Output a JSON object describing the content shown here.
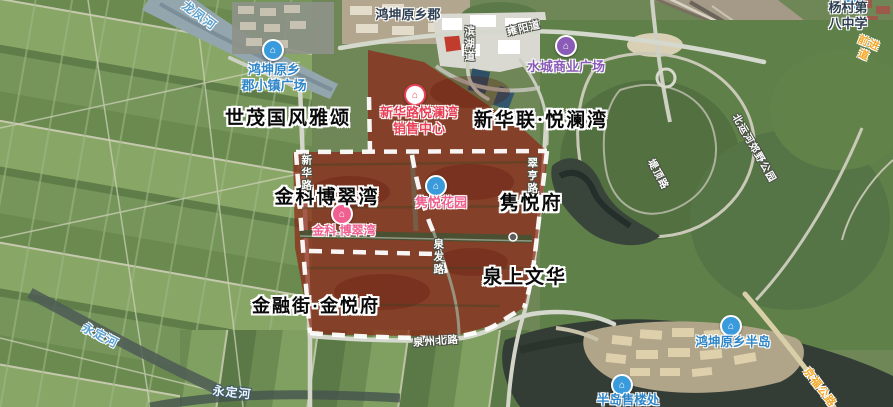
{
  "map": {
    "view_type": "satellite",
    "overlay": {
      "description": "red highlighted land parcel with white dashed boundary",
      "fill_color": "#8f1f12",
      "boundary_color": "#ffffff"
    }
  },
  "theme": {
    "poi_dark": "#2f3f52",
    "poi_blue": "#2e86c8",
    "poi_purple": "#8b5bb8",
    "poi_red": "#e84057",
    "poi_pink": "#ef5f8f",
    "river_blue": "#5aa0d0",
    "road_label_white": "#ffffff",
    "road_label_orange": "#f5a623",
    "annotation_black": "#0a0a0a"
  },
  "poi_labels": [
    {
      "text": "鸿坤原乡郡",
      "color": "dark",
      "icon": null
    },
    {
      "text": "杨村第八中学",
      "color": "dark",
      "icon": "school-marker"
    },
    {
      "text": "鸿坤原乡\n郡小镇广场",
      "color": "blue",
      "icon": "plaza-marker"
    },
    {
      "text": "水城商业广场",
      "color": "purple",
      "icon": "mall-marker"
    },
    {
      "text": "新华路悦澜湾\n销售中心",
      "color": "red",
      "icon": "sales-office-marker"
    },
    {
      "text": "隽悦花园",
      "color": "pink",
      "icon": "garden-marker"
    },
    {
      "text": "金科.博翠湾",
      "color": "pink",
      "icon": "residence-marker"
    },
    {
      "text": "鸿坤原乡半岛",
      "color": "blue",
      "icon": "peninsula-marker"
    },
    {
      "text": "半岛售楼处",
      "color": "blue",
      "icon": "sales-office-marker"
    }
  ],
  "annotation_labels": [
    {
      "text": "世茂国风雅颂"
    },
    {
      "text": "新华联·悦澜湾"
    },
    {
      "text": "金科博翠湾"
    },
    {
      "text": "隽悦府"
    },
    {
      "text": "泉上文华"
    },
    {
      "text": "金融街·金悦府"
    }
  ],
  "river_labels": [
    {
      "text": "龙凤河"
    },
    {
      "text": "永定河"
    },
    {
      "text": "永定河"
    }
  ],
  "road_labels": [
    {
      "text": "新华路",
      "style": "white"
    },
    {
      "text": "翠亨路",
      "style": "white"
    },
    {
      "text": "泉发路",
      "style": "white"
    },
    {
      "text": "泉州北路",
      "style": "white"
    },
    {
      "text": "滨湖道",
      "style": "white"
    },
    {
      "text": "雍阳道",
      "style": "white"
    },
    {
      "text": "堤顶路",
      "style": "white"
    },
    {
      "text": "北运河郊野公园",
      "style": "white"
    },
    {
      "text": "前进道",
      "style": "orange"
    },
    {
      "text": "京福公路",
      "style": "orange"
    }
  ]
}
